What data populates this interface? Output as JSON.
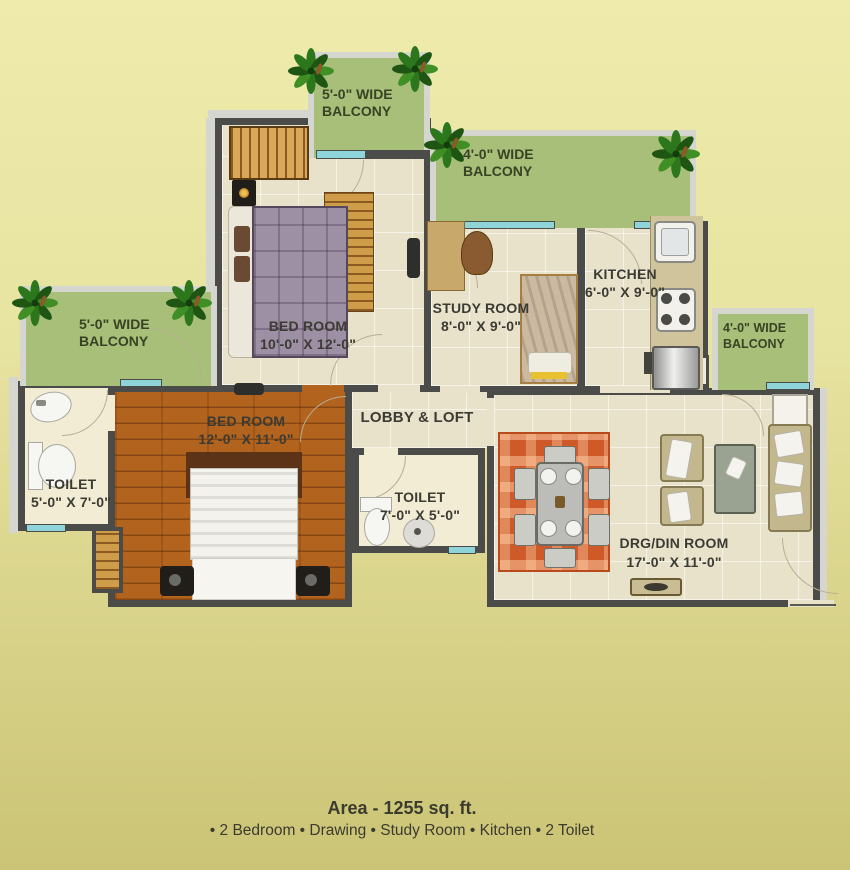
{
  "balconies": {
    "top_left": {
      "line1": "5'-0\" WIDE",
      "line2": "BALCONY"
    },
    "top_right": {
      "line1": "4'-0\" WIDE",
      "line2": "BALCONY"
    },
    "left": {
      "line1": "5'-0\" WIDE",
      "line2": "BALCONY"
    },
    "right": {
      "line1": "4'-0\" WIDE",
      "line2": "BALCONY"
    }
  },
  "rooms": {
    "bedroom1": {
      "name": "BED ROOM",
      "dims": "10'-0\" X 12'-0\""
    },
    "study_room": {
      "name": "STUDY ROOM",
      "dims": "8'-0\" X 9'-0\""
    },
    "kitchen": {
      "name": "KITCHEN",
      "dims": "6'-0\" X 9'-0\""
    },
    "bedroom2": {
      "name": "BED ROOM",
      "dims": "12'-0\" X 11'-0\""
    },
    "lobby": {
      "name": "LOBBY & LOFT"
    },
    "toilet1": {
      "name": "TOILET",
      "dims": "5'-0\" X 7'-0\""
    },
    "toilet2": {
      "name": "TOILET",
      "dims": "7'-0\" X 5'-0\""
    },
    "drg_din": {
      "name": "DRG/DIN ROOM",
      "dims": "17'-0\" X 11'-0\""
    }
  },
  "footer": {
    "area": "Area - 1255 sq. ft.",
    "features": "• 2 Bedroom • Drawing • Study Room • Kitchen • 2 Toilet"
  },
  "colors": {
    "balcony_green": "#a7bf79",
    "wall_dark": "#4b4b49",
    "tile_floor": "#e9e2cb",
    "wood_floor": "#b2641f",
    "rug_orange": "#cd5a28",
    "window_cyan": "#8fd4d8",
    "background_top": "#eeebac",
    "background_bottom": "#cbc476"
  }
}
